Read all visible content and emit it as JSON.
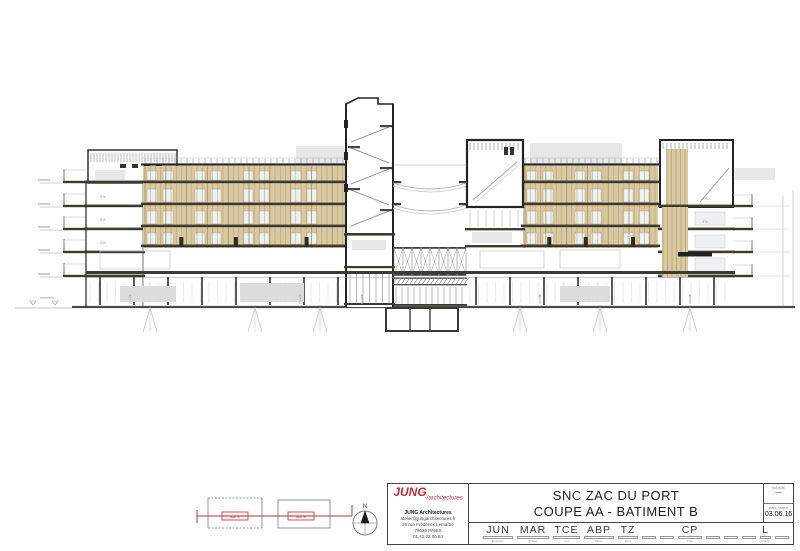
{
  "title_block": {
    "logo_main": "JUNG",
    "logo_sub": "/architectures",
    "firm_name": "JUNG Architectures",
    "firm_lines": [
      "atelier@jungarchitectures.fr",
      "20 rue Frédérick Lemaître",
      "75020 PARIS",
      "01.42.02.06.84"
    ],
    "project_title": "SNC ZAC DU PORT",
    "drawing_title": "COUPE AA - BATIMENT B",
    "scale_label": "echelle",
    "scale_value": "—",
    "date_label": "date indice",
    "date_value": "03.06.16",
    "codes": [
      {
        "code": "JUN",
        "label": "Emetteur",
        "w": 30
      },
      {
        "code": "MAR",
        "label": "Phase",
        "w": 32
      },
      {
        "code": "TCE",
        "label": "Lot",
        "w": 27
      },
      {
        "code": "ABP",
        "label": "Affect.",
        "w": 30
      },
      {
        "code": "TZ",
        "label": "Zone",
        "w": 20
      },
      {
        "code": "",
        "label": "",
        "w": 14
      },
      {
        "code": "",
        "label": "",
        "w": 14
      },
      {
        "code": "CP",
        "label": "Type",
        "w": 24
      },
      {
        "code": "",
        "label": "",
        "w": 14
      },
      {
        "code": "",
        "label": "",
        "w": 14
      },
      {
        "code": "",
        "label": "",
        "w": 14
      },
      {
        "code": "L",
        "label": "Indice",
        "w": 11
      },
      {
        "code": "",
        "label": "",
        "w": 14
      }
    ]
  },
  "key_plans": {
    "bat_a": "BAT A",
    "bat_b": "BAT B",
    "north": "N"
  },
  "annotations": {
    "slope": "3%"
  },
  "colors": {
    "tan": "#d8c9a0",
    "tanDark": "#a89869",
    "slab": "#3c3a33",
    "ink": "#232323",
    "mid": "#8c8c8c",
    "light": "#c8c8c8",
    "pale": "#e7e7e7",
    "window": "#eef0f2",
    "red": "#c03030",
    "ground": "#4a4a4a"
  }
}
